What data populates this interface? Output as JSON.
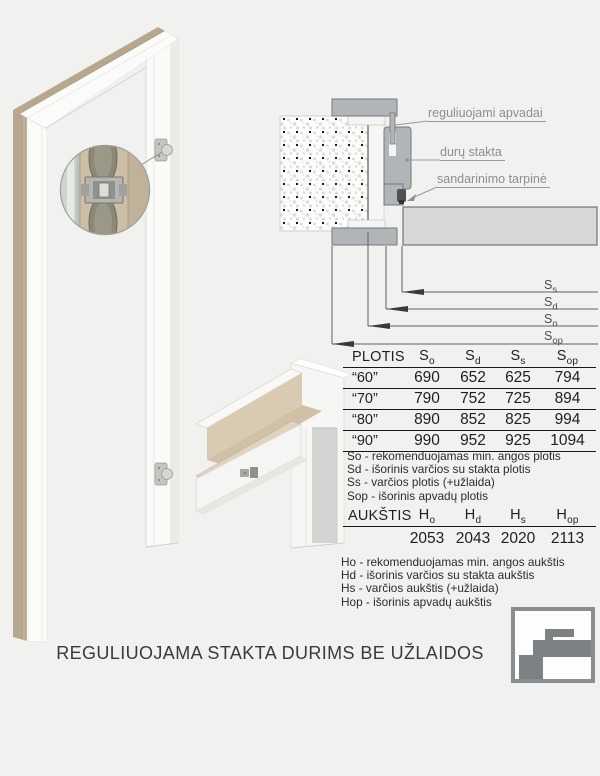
{
  "page": {
    "background": "#f1f1ef",
    "footer_title": "REGULIUOJAMA STAKTA DURIMS BE UŽLAIDOS"
  },
  "section_diagram": {
    "labels": {
      "apvadai": "reguliuojami apvadai",
      "stakta": "durų stakta",
      "tarpine": "sandarinimo tarpinė"
    },
    "dimensions": [
      {
        "base": "S",
        "sub": "s"
      },
      {
        "base": "S",
        "sub": "d"
      },
      {
        "base": "S",
        "sub": "o"
      },
      {
        "base": "S",
        "sub": "op"
      }
    ]
  },
  "plotis_table": {
    "title": "PLOTIS",
    "columns": [
      {
        "base": "S",
        "sub": "o"
      },
      {
        "base": "S",
        "sub": "d"
      },
      {
        "base": "S",
        "sub": "s"
      },
      {
        "base": "S",
        "sub": "op"
      }
    ],
    "rows": [
      {
        "label": "“60”",
        "values": [
          "690",
          "652",
          "625",
          "794"
        ]
      },
      {
        "label": "“70”",
        "values": [
          "790",
          "752",
          "725",
          "894"
        ]
      },
      {
        "label": "“80”",
        "values": [
          "890",
          "852",
          "825",
          "994"
        ]
      },
      {
        "label": "“90”",
        "values": [
          "990",
          "952",
          "925",
          "1094"
        ]
      }
    ],
    "legend": [
      "So - rekomenduojamas min. angos plotis",
      "Sd - išorinis varčios su stakta plotis",
      "Ss - varčios plotis (+užlaida)",
      "Sop - išorinis apvadų plotis"
    ]
  },
  "aukstis_table": {
    "title": "AUKŠTIS",
    "columns": [
      {
        "base": "H",
        "sub": "o"
      },
      {
        "base": "H",
        "sub": "d"
      },
      {
        "base": "H",
        "sub": "s"
      },
      {
        "base": "H",
        "sub": "op"
      }
    ],
    "values": [
      "2053",
      "2043",
      "2020",
      "2113"
    ],
    "legend": [
      "Ho - rekomenduojamas min. angos aukštis",
      "Hd - išorinis varčios su stakta aukštis",
      "Hs - varčios aukštis (+užlaida)",
      "Hop - išorinis apvadų aukštis"
    ]
  },
  "colors": {
    "profile_gray": "#b2b5b7",
    "door_leaf_gray": "#d6d8d8",
    "plywood_beige": "#cdbfa5",
    "label_gray": "#8e8e8c"
  }
}
